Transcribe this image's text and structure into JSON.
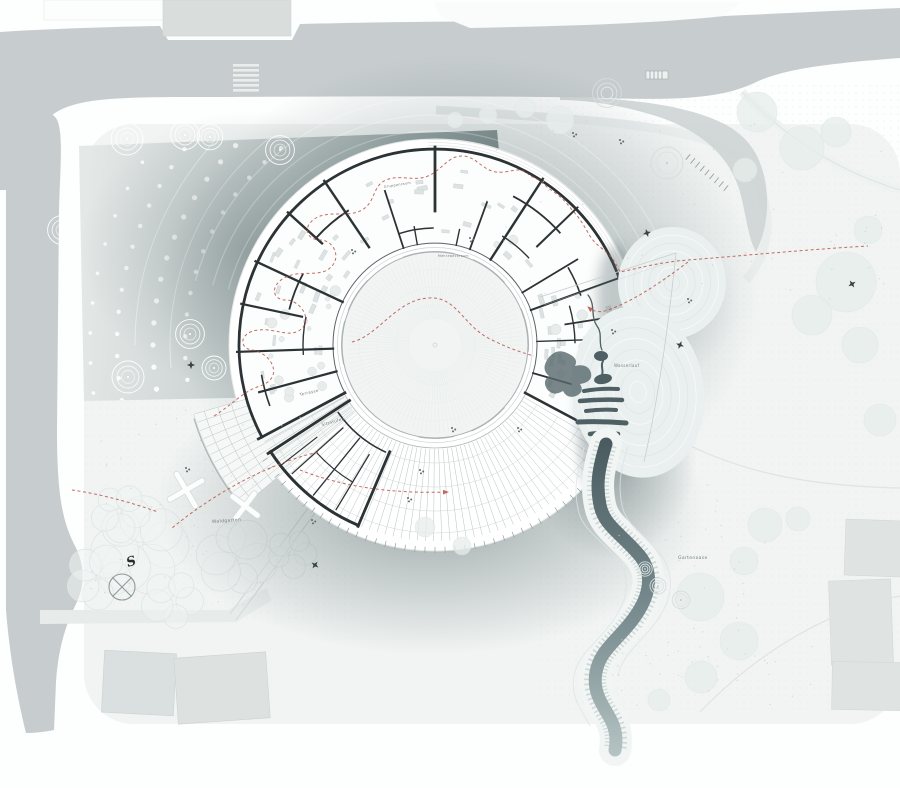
{
  "palette": {
    "road": "#c7cdce",
    "roadSlip": "#ced4d4",
    "sidewalk": "#e9eeed",
    "island": "#fafbfb",
    "land": "#f1f4f3",
    "plazaLight": "#e4e8e7",
    "plazaDark": "#7b8b8c",
    "shadow": "#3e5054",
    "plate": "#ffffff",
    "wall": "#2c3335",
    "wallLight": "#5a6467",
    "bench": "#9fa9a9",
    "red": "#b8544a",
    "riverDeep": "#46585c",
    "riverLight": "#b7c5c4",
    "treeFaint": "#e7eeec",
    "bldgFill": "#dadfdf",
    "bldgStroke": "#ccd2d2"
  },
  "labels": [
    {
      "text": "Waldgarten",
      "x": 212,
      "y": 523,
      "size": 4.5,
      "rot": -4
    },
    {
      "text": "Gartenoase",
      "x": 678,
      "y": 559,
      "size": 4.5,
      "rot": 0
    },
    {
      "text": "Terrasse",
      "x": 300,
      "y": 396,
      "size": 4,
      "rot": -13
    },
    {
      "text": "Sitzstufen",
      "x": 322,
      "y": 426,
      "size": 4,
      "rot": -15
    },
    {
      "text": "Wasserlauf",
      "x": 614,
      "y": 367,
      "size": 4,
      "rot": 0
    },
    {
      "text": "Gruppenraum",
      "x": 384,
      "y": 188,
      "size": 3.4,
      "rot": -9
    },
    {
      "text": "Mehrzweckraum",
      "x": 438,
      "y": 257,
      "size": 3.2,
      "rot": 0
    },
    {
      "text": "S",
      "x": 128,
      "y": 567,
      "size": 13,
      "rot": -18,
      "cls": "compass"
    }
  ],
  "plan": {
    "center": [
      435,
      345
    ],
    "plateR": 206,
    "outerWallR": 196,
    "innerWallR": 102,
    "planA0": 152,
    "planA1": 388,
    "walls": [
      [
        152,
        102,
        200,
        2.8
      ],
      [
        165,
        102,
        182,
        2.2
      ],
      [
        178,
        102,
        198,
        2.2
      ],
      [
        192,
        136,
        198,
        2.2
      ],
      [
        205,
        102,
        198,
        2.4
      ],
      [
        222,
        152,
        198,
        2.4
      ],
      [
        236,
        118,
        198,
        2.4
      ],
      [
        252,
        102,
        162,
        1.8
      ],
      [
        260,
        102,
        120,
        1.4
      ],
      [
        270,
        134,
        198,
        2.8
      ],
      [
        282,
        102,
        118,
        1.4
      ],
      [
        290,
        102,
        152,
        1.8
      ],
      [
        303,
        102,
        198,
        2.4
      ],
      [
        316,
        142,
        198,
        2
      ],
      [
        329,
        102,
        166,
        1.8
      ],
      [
        340,
        102,
        198,
        2
      ],
      [
        351,
        132,
        198,
        1.8
      ],
      [
        358,
        102,
        150,
        1.4
      ],
      [
        368,
        150,
        198,
        1.6
      ],
      [
        376,
        102,
        198,
        1.8
      ],
      [
        388,
        102,
        200,
        2.6
      ]
    ],
    "arcWalls": [
      [
        160,
        222,
        237,
        2
      ],
      [
        150,
        194,
        208,
        1.8
      ],
      [
        168,
        298,
        318,
        1.8
      ],
      [
        128,
        302,
        317,
        1.4
      ],
      [
        154,
        330,
        341,
        1.6
      ],
      [
        140,
        344,
        359,
        1.4
      ],
      [
        117,
        252,
        269,
        1.4
      ],
      [
        176,
        160,
        170,
        1.6
      ],
      [
        132,
        176,
        192,
        1.4
      ]
    ],
    "amphi": {
      "walls": [
        [
          113,
          116,
          197,
          2.8
        ],
        [
          147,
          102,
          199,
          2.8
        ],
        [
          121,
          128,
          192,
          1.3
        ],
        [
          129,
          120,
          193,
          1.3
        ],
        [
          138,
          124,
          192,
          1.3
        ],
        [
          142,
          150,
          196,
          1.2
        ]
      ],
      "arcs": [
        [
          196,
          113,
          147,
          3
        ],
        [
          118,
          115,
          145,
          1.6
        ],
        [
          160,
          121,
          138,
          1.2
        ]
      ]
    },
    "terrace": {
      "a0": 28,
      "a1": 152,
      "step": 2.4,
      "r0": 104,
      "r1": 196,
      "arcs": [
        118,
        142,
        166,
        188
      ],
      "innerEdgeR": 103,
      "ticks": {
        "a0": 34,
        "a1": 148,
        "step": 2.8,
        "r0": 202,
        "r1": 208
      },
      "fan": {
        "a0": 140,
        "a1": 164,
        "r1": 252,
        "step": 2,
        "arcs": [
          212,
          226,
          240,
          251
        ]
      }
    },
    "courtyard": {
      "r": 93,
      "hatchStep": 3,
      "hatchR0": 26,
      "hatchR1": 88,
      "rings": [
        40,
        58,
        76
      ],
      "benches": {
        "r0": 78,
        "r1": 94,
        "segs": [
          [
            168,
            195
          ],
          [
            202,
            224
          ],
          [
            250,
            282
          ],
          [
            294,
            318
          ],
          [
            337,
            364
          ],
          [
            42,
            67
          ],
          [
            78,
            100
          ]
        ]
      }
    },
    "plazaDots": {
      "radii": [
        250,
        282,
        318,
        345
      ],
      "step": [
        5,
        4.5,
        4,
        5
      ],
      "dot": [
        2.2,
        2.6,
        2.2,
        1.8
      ],
      "a0": 162,
      "a1": 243,
      "lines": [
        [
          265,
          175,
          236
        ],
        [
          300,
          180,
          232
        ]
      ]
    },
    "halo": [
      214,
      230,
      248
    ],
    "plateArcs": [
      199.5,
      202.5,
      205.5
    ],
    "furniture": [
      {
        "a0": 156,
        "a1": 266,
        "r0": 110,
        "r1": 188,
        "n": 30,
        "kind": "rect"
      },
      {
        "a0": 274,
        "a1": 384,
        "r0": 110,
        "r1": 188,
        "n": 30,
        "kind": "rect"
      },
      {
        "a0": 158,
        "a1": 210,
        "r0": 112,
        "r1": 180,
        "n": 16,
        "kind": "circle"
      },
      {
        "a0": 300,
        "a1": 380,
        "r0": 112,
        "r1": 158,
        "n": 10,
        "kind": "circle"
      }
    ]
  },
  "trees": {
    "ring": [
      {
        "x": 127,
        "y": 139,
        "s": 1,
        "v": "w"
      },
      {
        "x": 185,
        "y": 135,
        "s": 0.9,
        "v": "w"
      },
      {
        "x": 210,
        "y": 137,
        "s": 0.8,
        "v": "w"
      },
      {
        "x": 280,
        "y": 150,
        "s": 0.9,
        "v": "w"
      },
      {
        "x": 62,
        "y": 230,
        "s": 0.9,
        "v": "w"
      },
      {
        "x": 128,
        "y": 377,
        "s": 1,
        "v": "w"
      },
      {
        "x": 190,
        "y": 334,
        "s": 0.9,
        "v": "w"
      },
      {
        "x": 214,
        "y": 368,
        "s": 0.75,
        "v": "w"
      },
      {
        "x": 607,
        "y": 93,
        "s": 0.9,
        "v": "g"
      },
      {
        "x": 667,
        "y": 163,
        "s": 1,
        "v": "g"
      },
      {
        "x": 645,
        "y": 569,
        "s": 0.45,
        "v": "g"
      },
      {
        "x": 658,
        "y": 586,
        "s": 0.5,
        "v": "g"
      },
      {
        "x": 681,
        "y": 600,
        "s": 0.55,
        "v": "g"
      }
    ],
    "faint": [
      [
        757,
        112,
        20
      ],
      [
        802,
        148,
        22
      ],
      [
        836,
        132,
        15
      ],
      [
        745,
        170,
        12
      ],
      [
        846,
        282,
        30
      ],
      [
        812,
        315,
        20
      ],
      [
        860,
        345,
        18
      ],
      [
        765,
        525,
        17
      ],
      [
        798,
        519,
        12
      ],
      [
        744,
        561,
        14
      ],
      [
        700,
        597,
        24
      ],
      [
        739,
        641,
        19
      ],
      [
        701,
        677,
        16
      ],
      [
        659,
        700,
        11
      ],
      [
        560,
        120,
        14
      ],
      [
        525,
        108,
        10
      ],
      [
        488,
        115,
        9
      ],
      [
        455,
        120,
        8
      ],
      [
        425,
        527,
        10
      ],
      [
        462,
        546,
        9
      ],
      [
        868,
        230,
        14
      ],
      [
        880,
        420,
        16
      ]
    ],
    "clouds": [
      [
        140,
        545,
        42,
        7
      ],
      [
        237,
        558,
        34,
        6
      ],
      [
        173,
        600,
        27,
        5
      ],
      [
        98,
        577,
        28,
        5
      ],
      [
        292,
        553,
        22,
        5
      ],
      [
        120,
        512,
        26,
        5
      ]
    ]
  },
  "scatter": {
    "speckleRects": [
      [
        88,
        410,
        230,
        195,
        60
      ],
      [
        610,
        480,
        160,
        200,
        40
      ],
      [
        470,
        120,
        420,
        180,
        55
      ],
      [
        620,
        620,
        200,
        90,
        25
      ]
    ],
    "clusters": [
      [
        408,
        498
      ],
      [
        452,
        428
      ],
      [
        518,
        428
      ],
      [
        352,
        250
      ],
      [
        470,
        238
      ],
      [
        612,
        330
      ],
      [
        688,
        299
      ],
      [
        186,
        468
      ],
      [
        573,
        133
      ],
      [
        620,
        140
      ],
      [
        312,
        520
      ],
      [
        420,
        470
      ]
    ],
    "stars": [
      [
        191,
        365
      ],
      [
        315,
        565
      ],
      [
        647,
        233
      ],
      [
        680,
        345
      ],
      [
        852,
        284
      ]
    ],
    "xBenches": [
      {
        "x": 186,
        "y": 490,
        "rot": 15,
        "s": 13
      },
      {
        "x": 245,
        "y": 506,
        "rot": -8,
        "s": 11
      }
    ],
    "compass": {
      "x": 122,
      "y": 587,
      "r": 13
    },
    "tickrows": [
      {
        "x0": 688,
        "y0": 157,
        "x1": 726,
        "y1": 188,
        "n": 9,
        "len": 7
      }
    ],
    "mounds": [
      {
        "cx": 672,
        "cy": 283,
        "rx": 54,
        "ry": 56,
        "rot": 8,
        "n": 6
      },
      {
        "cx": 638,
        "cy": 392,
        "rx": 66,
        "ry": 86,
        "rot": -8,
        "n": 7
      }
    ]
  }
}
